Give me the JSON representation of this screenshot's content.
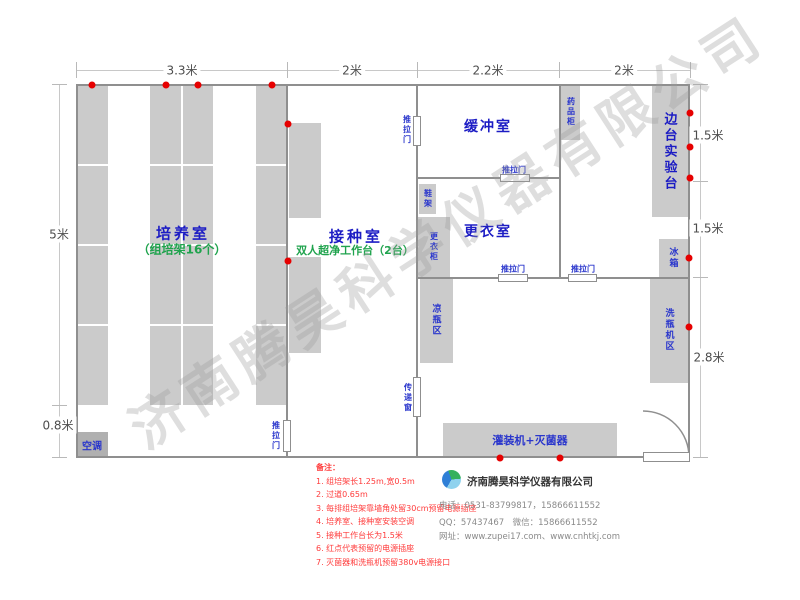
{
  "watermark": "济南腾昊科学仪器有限公司",
  "dimensions": {
    "top": [
      "3.3米",
      "2米",
      "2.2米",
      "2米"
    ],
    "left": [
      "5米",
      "0.8米"
    ],
    "right": [
      "1.5米",
      "1.5米",
      "2.8米"
    ]
  },
  "rooms": {
    "cultivation": {
      "name": "培养室",
      "sub": "（组培架16个）"
    },
    "inoculation": {
      "name": "接种室",
      "sub": "双人超净工作台（2台）"
    },
    "buffer": {
      "name": "缓冲室"
    },
    "changing": {
      "name": "更衣室"
    },
    "side_bench": {
      "name": "边台实验台"
    }
  },
  "furniture": {
    "ac": "空调",
    "medicine_cabinet": "药品柜",
    "shoe_rack": "鞋架",
    "wardrobe": "更衣柜",
    "cooling_area": "凉瓶区",
    "transfer_window": "传递窗",
    "fridge": "冰箱",
    "bottle_washer": "洗瓶机区",
    "filling_sterilizer": "灌装机+灭菌器"
  },
  "labels": {
    "sliding_door": "推拉门"
  },
  "notes": {
    "title": "备注：",
    "items": [
      "1. 组培架长1.25m,宽0.5m",
      "2. 过道0.65m",
      "3. 每排组培架靠墙角处留30cm预留电源插座",
      "4. 培养室、接种室安装空调",
      "5. 接种工作台长为1.5米",
      "6. 红点代表预留的电源插座",
      "7. 灭菌器和洗瓶机预留380v电源接口"
    ]
  },
  "company": {
    "name": "济南腾昊科学仪器有限公司",
    "phone": "电话：0531-83799817，15866611552",
    "qq_wechat": "QQ：57437467　微信：15866611552",
    "website": "网址：www.zupei17.com、www.cnhtkj.com"
  },
  "colors": {
    "wall": "#8f8f8f",
    "block": "#cbcbcb",
    "label_blue": "#2a36cc",
    "room_blue": "#1c1cc4",
    "sub_green": "#1fa34d",
    "outlet_red": "#e60000",
    "note_red": "#ff3b3b"
  }
}
